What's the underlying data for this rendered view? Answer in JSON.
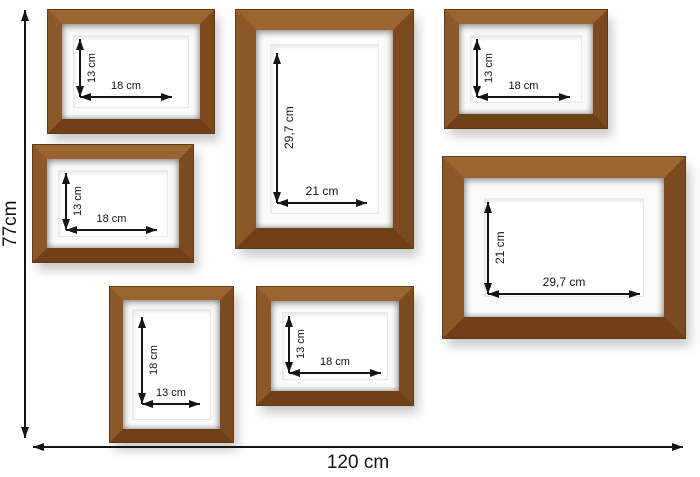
{
  "overall": {
    "height_label": "77cm",
    "width_label": "120 cm"
  },
  "frames": [
    {
      "position": "top-left",
      "orientation": "landscape",
      "width_label": "18 cm",
      "height_label": "13 cm"
    },
    {
      "position": "middle-left",
      "orientation": "landscape",
      "width_label": "18 cm",
      "height_label": "13 cm"
    },
    {
      "position": "bottom-left",
      "orientation": "portrait",
      "width_label": "13 cm",
      "height_label": "18 cm"
    },
    {
      "position": "center",
      "orientation": "portrait",
      "width_label": "21 cm",
      "height_label": "29,7 cm"
    },
    {
      "position": "bottom-center",
      "orientation": "landscape",
      "width_label": "18 cm",
      "height_label": "13 cm"
    },
    {
      "position": "top-right",
      "orientation": "landscape",
      "width_label": "18 cm",
      "height_label": "13 cm"
    },
    {
      "position": "right",
      "orientation": "landscape",
      "width_label": "29,7 cm",
      "height_label": "21 cm"
    }
  ],
  "colors": {
    "background": "#ffffff",
    "wood_light": "#9a6530",
    "wood_mid": "#8a5527",
    "wood_dark": "#6f4017",
    "wood_edge": "#5e3a16",
    "mat": "#fbfbfb",
    "arrow": "#141414"
  }
}
